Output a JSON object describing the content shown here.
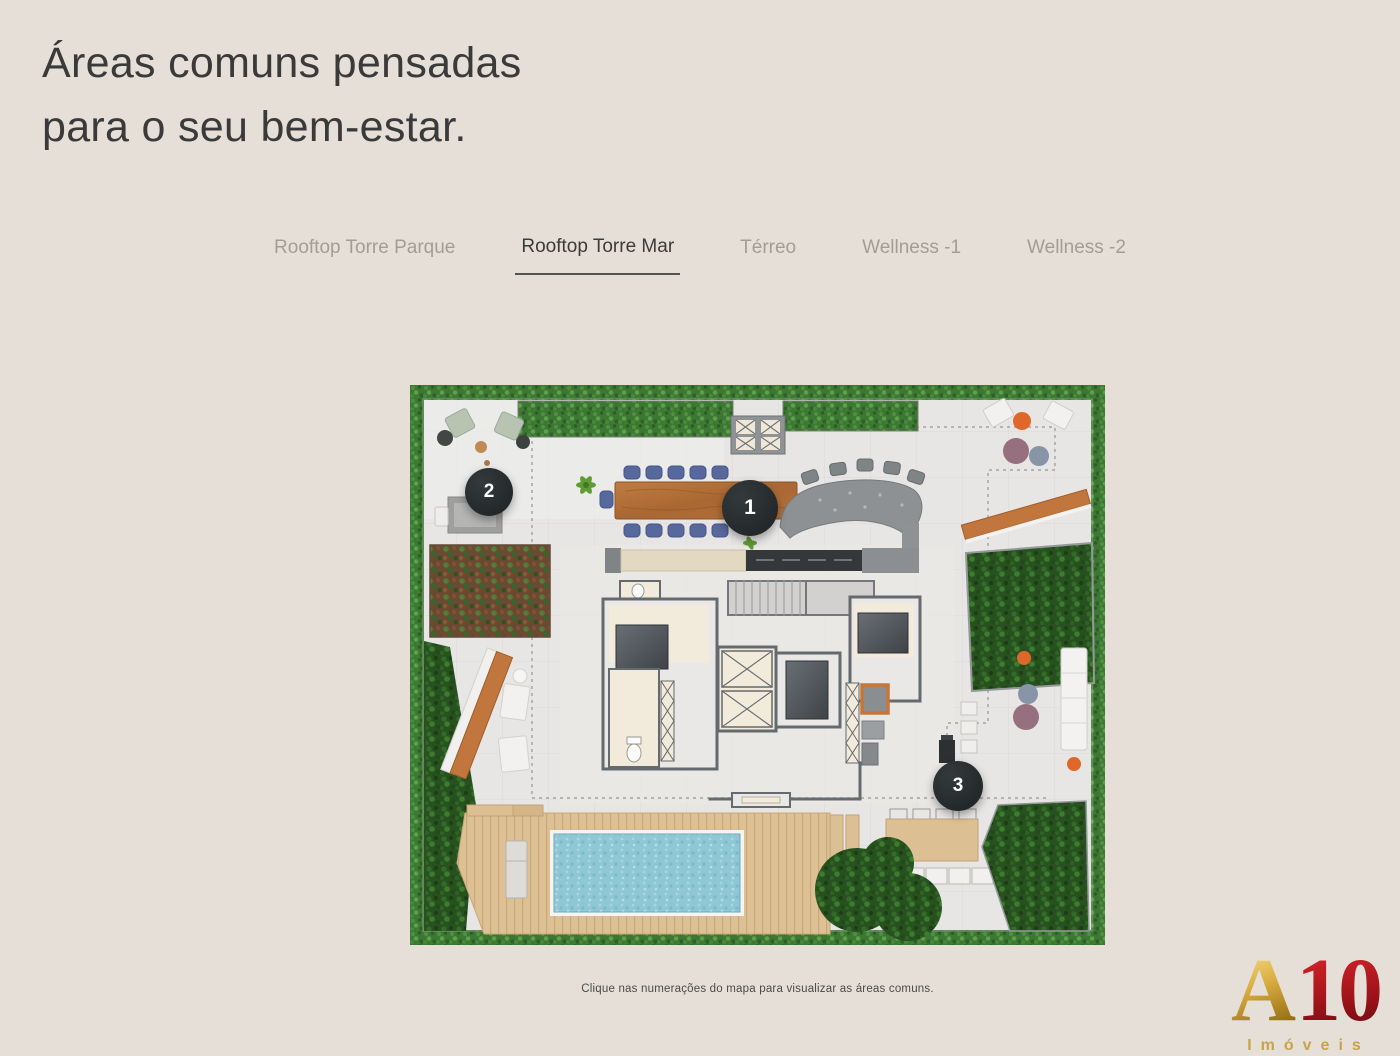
{
  "page": {
    "title_line1": "Áreas comuns pensadas",
    "title_line2": "para o seu bem-estar.",
    "caption": "Clique nas numerações do mapa para visualizar as áreas comuns."
  },
  "tabs": [
    {
      "label": "Rooftop Torre Parque",
      "active": false
    },
    {
      "label": "Rooftop Torre Mar",
      "active": true
    },
    {
      "label": "Térreo",
      "active": false
    },
    {
      "label": "Wellness -1",
      "active": false
    },
    {
      "label": "Wellness -2",
      "active": false
    }
  ],
  "map_markers": [
    {
      "number": "1"
    },
    {
      "number": "2"
    },
    {
      "number": "3"
    }
  ],
  "logo": {
    "letter": "A",
    "number": "10",
    "subtitle": "Imóveis"
  },
  "colors": {
    "page_background": "#e5dfd8",
    "title_text": "#3a3a3a",
    "tab_inactive": "#a39d94",
    "tab_active": "#3d3b37",
    "marker_background": "#24282a",
    "marker_text": "#ffffff",
    "hedge_green": "#3c7733",
    "pool_water": "#8fc7d4",
    "wood_table": "#b5713c",
    "deck_wood": "#ddc094",
    "logo_gold": "#c9a348",
    "logo_red": "#a3151b"
  }
}
